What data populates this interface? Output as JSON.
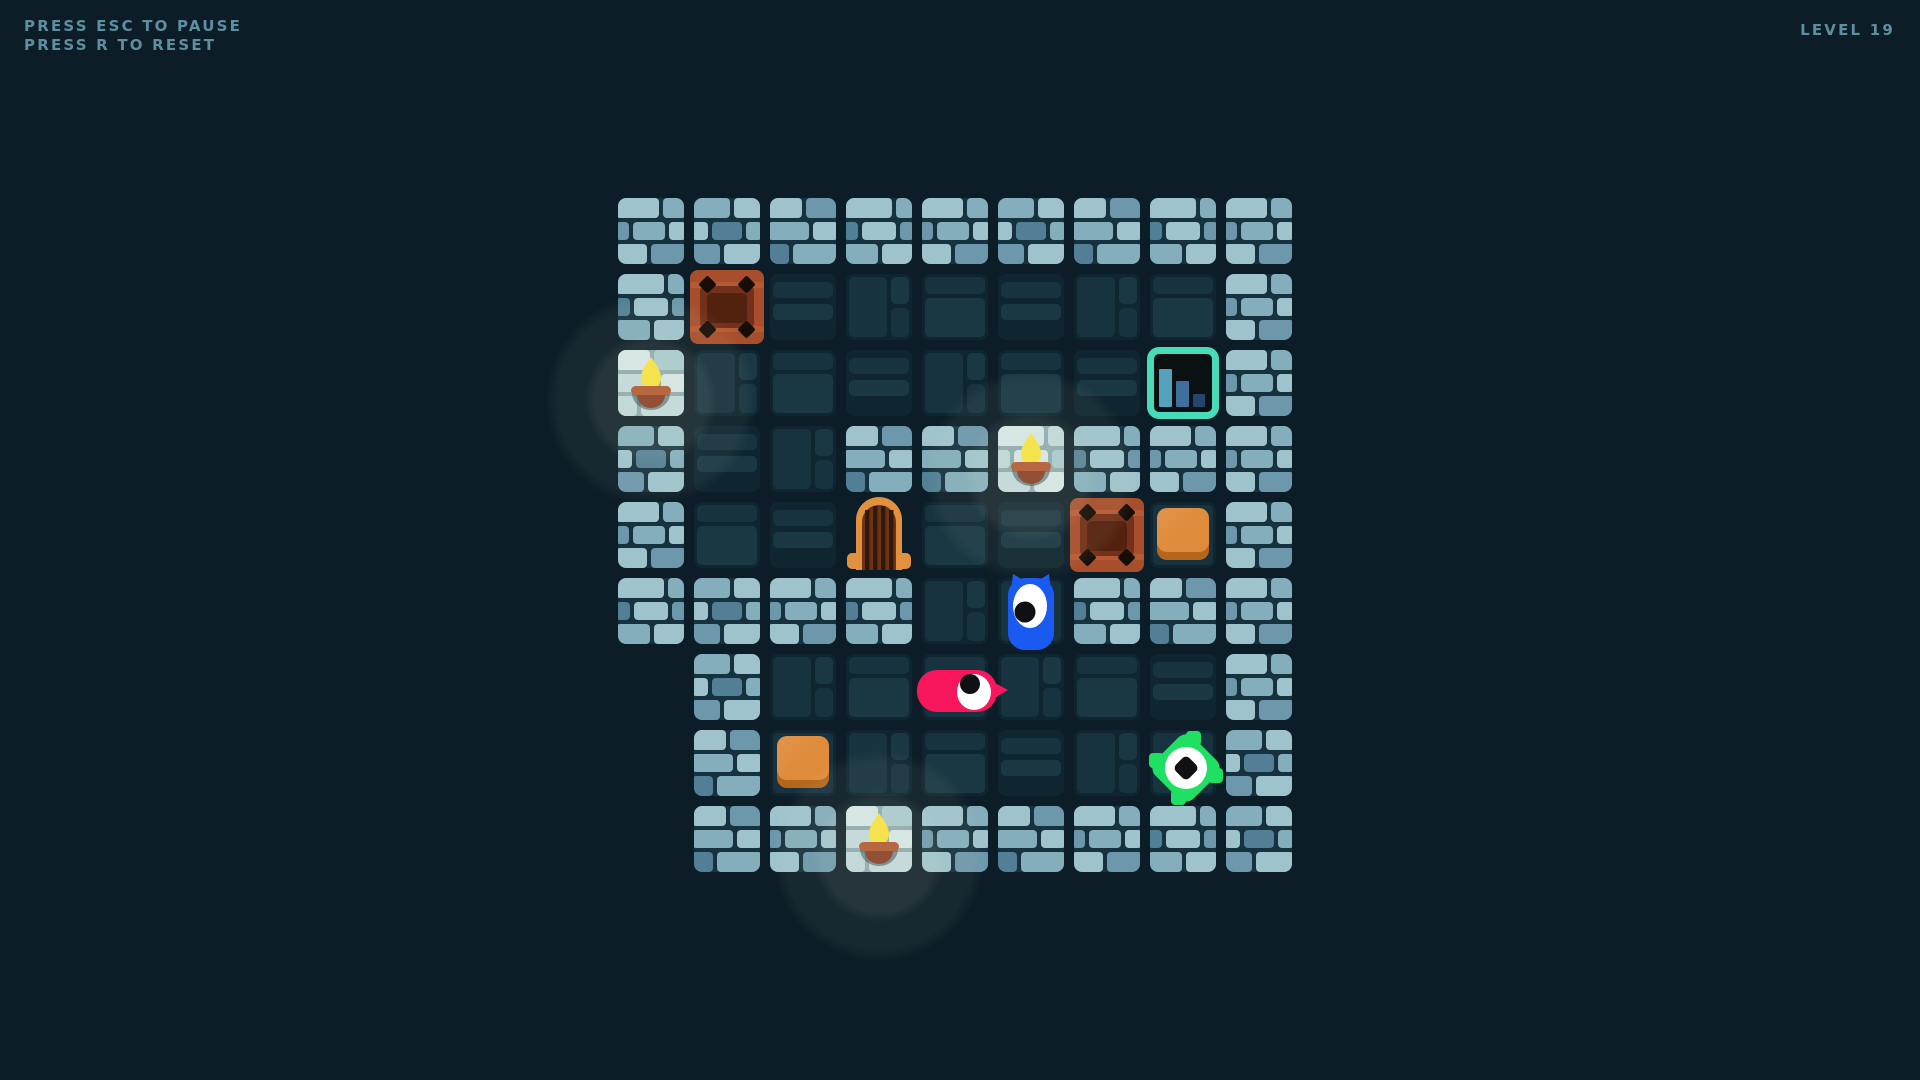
{
  "hud": {
    "pause_hint": "PRESS ESC TO PAUSE",
    "reset_hint": "PRESS R TO RESET",
    "level_label": "LEVEL 19"
  },
  "board": {
    "rows": 9,
    "cols": 9,
    "origin_x": 618,
    "origin_y": 198,
    "tile_size": 66,
    "tile_gap": 10,
    "legend": {
      "W": "wall",
      "F": "floor",
      "T": "torch-wall",
      "C": "crate",
      "D": "dungeon-door",
      "P": "exit-portal",
      "B": "push-block",
      "b": "blue-monster",
      "p": "pink-monster",
      "g": "green-monster",
      ".": "empty"
    },
    "map": [
      "WWWWWWWWW",
      "WCFFFFFFW",
      "TFFFFFFPW",
      "WFFWWTWWW",
      "WFFDFFCBW",
      "WWWWFbWWW",
      ".WFFpFFFW",
      ".WBFFFFgW",
      ".WWTWWWWW"
    ],
    "entities": [
      {
        "type": "crate",
        "row": 1,
        "col": 1
      },
      {
        "type": "torch",
        "row": 2,
        "col": 0
      },
      {
        "type": "exit-portal",
        "row": 2,
        "col": 7
      },
      {
        "type": "torch",
        "row": 3,
        "col": 5
      },
      {
        "type": "dungeon-door",
        "row": 4,
        "col": 3
      },
      {
        "type": "crate",
        "row": 4,
        "col": 6
      },
      {
        "type": "push-block",
        "row": 4,
        "col": 7
      },
      {
        "type": "blue-monster",
        "row": 5,
        "col": 5
      },
      {
        "type": "pink-monster",
        "row": 6,
        "col": 4
      },
      {
        "type": "push-block",
        "row": 7,
        "col": 2
      },
      {
        "type": "green-monster",
        "row": 7,
        "col": 7
      },
      {
        "type": "torch",
        "row": 8,
        "col": 3
      }
    ]
  },
  "colors": {
    "background": "#0c1d27",
    "hud_text": "#5d8fa0",
    "wall_mortar": "#16323e",
    "wall_bricks": [
      "#9fc3cc",
      "#84aebc",
      "#6d98ab",
      "#527f95"
    ],
    "lit_mortar": "#8ea9ae",
    "lit_bricks": [
      "#d6e6e6",
      "#c2d9db",
      "#aac9cf",
      "#bfd7d9"
    ],
    "floor_base": "#0f2631",
    "floor_bricks": [
      "#17333f",
      "#1a3844"
    ],
    "crate": {
      "frame": "#a84e2c",
      "band": "#b55a33",
      "inner": "#73301a",
      "inner_dark": "#53220f",
      "rivet": "#170d08"
    },
    "door": {
      "frame": "#e2913f",
      "interior": "#6b3317",
      "bar": "#331a08"
    },
    "block": {
      "top": "#e08b3c",
      "bottom": "#b4661d"
    },
    "portal": {
      "border": "#47dcb7",
      "interior": "#0b1013",
      "bars": [
        "#55a0bb",
        "#3f6f9d",
        "#24456e"
      ]
    },
    "torch": {
      "flame": "#f8e23c",
      "bar": "#b3572f",
      "bowl": "#8a3c22"
    },
    "monsters": {
      "blue": "#1a5af0",
      "pink": "#f8175c",
      "green": "#1fe062",
      "eye": "#ffffff",
      "pupil": "#101014"
    },
    "glow": "rgba(225,232,200,1)"
  }
}
